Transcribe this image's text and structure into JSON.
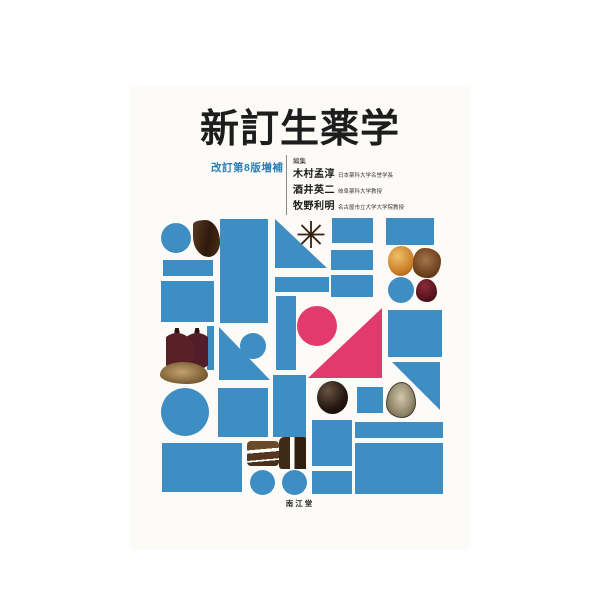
{
  "cover": {
    "title": "新訂生薬学",
    "edition": "改訂第8版増補",
    "editors_label": "編集",
    "editors": [
      {
        "name": "木村孟淳",
        "affiliation": "日本薬科大学名誉学長"
      },
      {
        "name": "酒井英二",
        "affiliation": "岐阜薬科大学教授"
      },
      {
        "name": "牧野利明",
        "affiliation": "名古屋市立大学大学院教授"
      }
    ],
    "publisher": "南江堂",
    "colors": {
      "blue": "#3e8ec4",
      "pink": "#e23a6d",
      "title_black": "#1d1d1d",
      "edition_blue": "#2b7fb5"
    }
  },
  "pattern": {
    "shapes": [
      {
        "kind": "circle",
        "name": "mosaic-circle-top-left",
        "x": 161,
        "y": 223,
        "w": 30,
        "h": 30,
        "fill": "blue"
      },
      {
        "kind": "rect",
        "name": "mosaic-bar-left-1",
        "x": 163,
        "y": 260,
        "w": 50,
        "h": 16,
        "fill": "blue"
      },
      {
        "kind": "rect",
        "name": "mosaic-rect-left-2",
        "x": 161,
        "y": 281,
        "w": 53,
        "h": 41,
        "fill": "blue"
      },
      {
        "kind": "rect",
        "name": "mosaic-thin-bar-left",
        "x": 207,
        "y": 326,
        "w": 7,
        "h": 44,
        "fill": "blue"
      },
      {
        "kind": "circle",
        "name": "mosaic-circle-left-big",
        "x": 161,
        "y": 388,
        "w": 48,
        "h": 48,
        "fill": "blue"
      },
      {
        "kind": "rect",
        "name": "mosaic-rect-bottom-left",
        "x": 162,
        "y": 443,
        "w": 80,
        "h": 49,
        "fill": "blue"
      },
      {
        "kind": "rect",
        "name": "mosaic-rect-tall-center-left",
        "x": 220,
        "y": 219,
        "w": 48,
        "h": 104,
        "fill": "blue"
      },
      {
        "kind": "triangle",
        "corner": "bl",
        "name": "mosaic-triangle-center-left",
        "x": 219,
        "y": 327,
        "w": 51,
        "h": 53,
        "fill": "blue"
      },
      {
        "kind": "circle",
        "name": "mosaic-circle-small-center",
        "x": 240,
        "y": 333,
        "w": 26,
        "h": 26,
        "fill": "blue"
      },
      {
        "kind": "rect",
        "name": "mosaic-square-center-left",
        "x": 218,
        "y": 388,
        "w": 50,
        "h": 49,
        "fill": "blue"
      },
      {
        "kind": "triangle",
        "corner": "bl",
        "name": "mosaic-triangle-top-center",
        "x": 275,
        "y": 219,
        "w": 52,
        "h": 49,
        "fill": "blue"
      },
      {
        "kind": "rect",
        "name": "mosaic-bar-center",
        "x": 275,
        "y": 277,
        "w": 54,
        "h": 15,
        "fill": "blue"
      },
      {
        "kind": "rect",
        "name": "mosaic-vbar-center",
        "x": 276,
        "y": 296,
        "w": 20,
        "h": 74,
        "fill": "blue"
      },
      {
        "kind": "circle",
        "name": "mosaic-circle-pink",
        "x": 297,
        "y": 306,
        "w": 40,
        "h": 40,
        "fill": "pink"
      },
      {
        "kind": "rect",
        "name": "mosaic-rect-center-bottom",
        "x": 273,
        "y": 375,
        "w": 33,
        "h": 62,
        "fill": "blue"
      },
      {
        "kind": "circle",
        "name": "mosaic-circle-bottom-1",
        "x": 250,
        "y": 470,
        "w": 25,
        "h": 25,
        "fill": "blue"
      },
      {
        "kind": "circle",
        "name": "mosaic-circle-bottom-2",
        "x": 282,
        "y": 470,
        "w": 25,
        "h": 25,
        "fill": "blue"
      },
      {
        "kind": "rect",
        "name": "mosaic-rect-mid-1",
        "x": 332,
        "y": 218,
        "w": 41,
        "h": 25,
        "fill": "blue"
      },
      {
        "kind": "rect",
        "name": "mosaic-rect-mid-2",
        "x": 331,
        "y": 250,
        "w": 42,
        "h": 20,
        "fill": "blue"
      },
      {
        "kind": "rect",
        "name": "mosaic-rect-mid-3",
        "x": 331,
        "y": 275,
        "w": 42,
        "h": 22,
        "fill": "blue"
      },
      {
        "kind": "triangle",
        "corner": "br",
        "name": "mosaic-triangle-pink",
        "x": 308,
        "y": 308,
        "w": 74,
        "h": 70,
        "fill": "pink"
      },
      {
        "kind": "rect",
        "name": "mosaic-square-mid-small",
        "x": 357,
        "y": 387,
        "w": 26,
        "h": 26,
        "fill": "blue"
      },
      {
        "kind": "rect",
        "name": "mosaic-rect-mid-bottom-1",
        "x": 312,
        "y": 420,
        "w": 40,
        "h": 46,
        "fill": "blue"
      },
      {
        "kind": "rect",
        "name": "mosaic-rect-mid-bottom-2",
        "x": 312,
        "y": 471,
        "w": 40,
        "h": 23,
        "fill": "blue"
      },
      {
        "kind": "rect",
        "name": "mosaic-rect-top-right",
        "x": 386,
        "y": 218,
        "w": 48,
        "h": 27,
        "fill": "blue"
      },
      {
        "kind": "circle",
        "name": "mosaic-circle-right",
        "x": 388,
        "y": 277,
        "w": 26,
        "h": 26,
        "fill": "blue"
      },
      {
        "kind": "rect",
        "name": "mosaic-square-right-big",
        "x": 388,
        "y": 310,
        "w": 54,
        "h": 47,
        "fill": "blue"
      },
      {
        "kind": "triangle",
        "corner": "tr",
        "name": "mosaic-triangle-right",
        "x": 392,
        "y": 362,
        "w": 48,
        "h": 48,
        "fill": "blue"
      },
      {
        "kind": "rect",
        "name": "mosaic-bar-bottom-right",
        "x": 355,
        "y": 422,
        "w": 88,
        "h": 16,
        "fill": "blue"
      },
      {
        "kind": "rect",
        "name": "mosaic-rect-bottom-right",
        "x": 355,
        "y": 443,
        "w": 88,
        "h": 51,
        "fill": "blue"
      },
      {
        "kind": "photo",
        "photo": "root",
        "name": "photo-dark-root",
        "x": 193,
        "y": 220,
        "w": 27,
        "h": 37
      },
      {
        "kind": "photo",
        "photo": "star",
        "name": "photo-star-anise",
        "x": 292,
        "y": 218,
        "w": 38,
        "h": 34,
        "glyph": "✳"
      },
      {
        "kind": "photo",
        "photo": "seeds",
        "name": "photo-red-seeds",
        "x": 166,
        "y": 328,
        "w": 42,
        "h": 40
      },
      {
        "kind": "photo",
        "photo": "pod",
        "name": "photo-tan-pod",
        "x": 160,
        "y": 362,
        "w": 48,
        "h": 22
      },
      {
        "kind": "photo",
        "photo": "gardenia",
        "name": "photo-orange-fruit",
        "x": 388,
        "y": 246,
        "w": 26,
        "h": 30
      },
      {
        "kind": "photo",
        "photo": "lump",
        "name": "photo-brown-lump",
        "x": 413,
        "y": 248,
        "w": 28,
        "h": 30
      },
      {
        "kind": "photo",
        "photo": "jujube",
        "name": "photo-jujube",
        "x": 416,
        "y": 279,
        "w": 21,
        "h": 23
      },
      {
        "kind": "photo",
        "photo": "sphere",
        "name": "photo-black-sphere",
        "x": 317,
        "y": 381,
        "w": 31,
        "h": 33
      },
      {
        "kind": "photo",
        "photo": "shell",
        "name": "photo-oyster-shell",
        "x": 386,
        "y": 382,
        "w": 30,
        "h": 36
      },
      {
        "kind": "photo",
        "photo": "bark",
        "name": "photo-bark-pieces",
        "x": 247,
        "y": 441,
        "w": 32,
        "h": 25
      },
      {
        "kind": "photo",
        "photo": "roots2",
        "name": "photo-two-roots",
        "x": 279,
        "y": 437,
        "w": 30,
        "h": 32
      }
    ]
  }
}
